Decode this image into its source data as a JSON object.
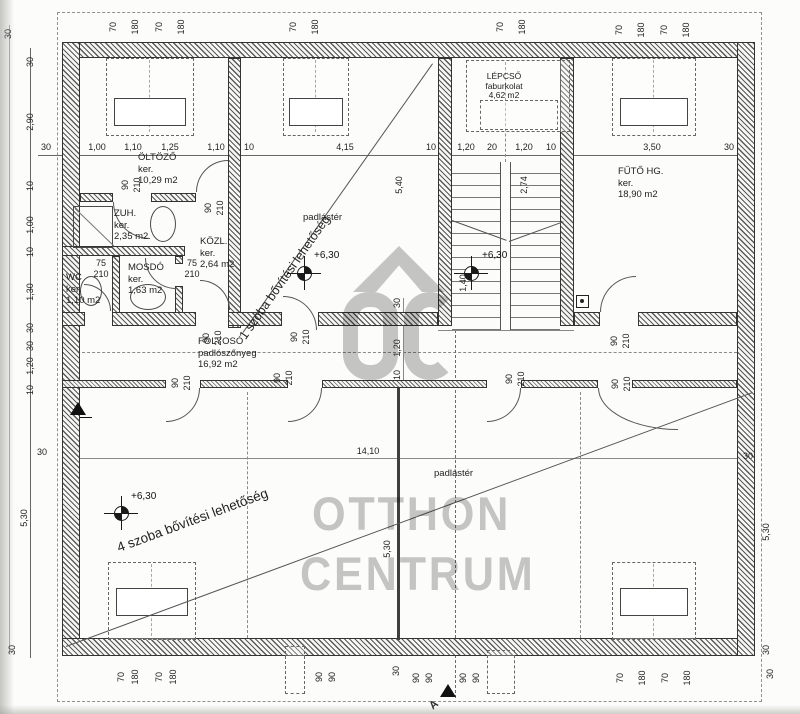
{
  "watermark": {
    "oc": "OC",
    "otthon": "OTTHON",
    "centrum": "CENTRUM"
  },
  "rooms": {
    "oltozo": {
      "name": "ÖLTÖZŐ",
      "floor": "ker.",
      "area": "10,29 m2"
    },
    "zuh": {
      "name": "ZUH.",
      "floor": "ker.",
      "area": "2,35 m2"
    },
    "kozl": {
      "name": "KÖZL.",
      "floor": "ker.",
      "area": "2,64 m2"
    },
    "wc": {
      "name": "WC",
      "floor": "ker.",
      "area": "1,10 m2"
    },
    "mosdo": {
      "name": "MOSDÓ",
      "floor": "ker.",
      "area": "1,63 m2"
    },
    "lepcso": {
      "name": "LÉPCSŐ",
      "floor": "faburkolat",
      "area": "4,62 m2"
    },
    "futo": {
      "name": "FŰTŐ HG.",
      "floor": "ker.",
      "area": "18,90 m2"
    },
    "folyoso": {
      "name": "FOLYOSÓ",
      "floor": "padlószőnyeg",
      "area": "16,92 m2"
    },
    "attic_top": {
      "label": "padlástér"
    },
    "attic_bottom": {
      "label": "padlástér"
    }
  },
  "annotations": {
    "expand1": "1 szoba bővítési lehetőség",
    "expand4": "4 szoba bővítési lehetőség",
    "level_top": "+6,30",
    "level_right": "+6,30",
    "level_bottom": "+6,30",
    "section_a": "A"
  },
  "dim_labels": [
    [
      "70",
      113,
      27,
      1
    ],
    [
      "180",
      135,
      27,
      1
    ],
    [
      "70",
      159,
      27,
      1
    ],
    [
      "180",
      181,
      27,
      1
    ],
    [
      "70",
      293,
      27,
      1
    ],
    [
      "180",
      315,
      27,
      1
    ],
    [
      "70",
      500,
      27,
      1
    ],
    [
      "180",
      522,
      27,
      1
    ],
    [
      "70",
      619,
      30,
      1
    ],
    [
      "180",
      641,
      30,
      1
    ],
    [
      "70",
      664,
      30,
      1
    ],
    [
      "180",
      686,
      30,
      1
    ],
    [
      "30",
      46,
      147,
      0
    ],
    [
      "1,00",
      97,
      147,
      0
    ],
    [
      "1,10",
      133,
      147,
      0
    ],
    [
      "1,25",
      170,
      147,
      0
    ],
    [
      "1,10",
      216,
      147,
      0
    ],
    [
      "10",
      249,
      147,
      0
    ],
    [
      "4,15",
      345,
      147,
      0
    ],
    [
      "10",
      431,
      147,
      0
    ],
    [
      "1,20",
      466,
      147,
      0
    ],
    [
      "20",
      492,
      147,
      0
    ],
    [
      "1,20",
      524,
      147,
      0
    ],
    [
      "10",
      551,
      147,
      0
    ],
    [
      "3,50",
      652,
      147,
      0
    ],
    [
      "30",
      729,
      147,
      0
    ],
    [
      "30",
      8,
      34,
      1
    ],
    [
      "30",
      30,
      62,
      1
    ],
    [
      "2,90",
      30,
      122,
      1
    ],
    [
      "10",
      30,
      186,
      1
    ],
    [
      "1,00",
      30,
      225,
      1
    ],
    [
      "10",
      30,
      252,
      1
    ],
    [
      "1,30",
      30,
      292,
      1
    ],
    [
      "30",
      30,
      328,
      1
    ],
    [
      "30",
      30,
      346,
      1
    ],
    [
      "1,20",
      30,
      366,
      1
    ],
    [
      "10",
      30,
      390,
      1
    ],
    [
      "30",
      42,
      452,
      0
    ],
    [
      "5,30",
      24,
      518,
      1
    ],
    [
      "30",
      12,
      650,
      1
    ],
    [
      "30",
      748,
      456,
      0
    ],
    [
      "5,30",
      766,
      532,
      1
    ],
    [
      "30",
      766,
      650,
      1
    ],
    [
      "70",
      121,
      677,
      1
    ],
    [
      "180",
      135,
      677,
      1
    ],
    [
      "70",
      159,
      677,
      1
    ],
    [
      "180",
      173,
      677,
      1
    ],
    [
      "90",
      319,
      677,
      1
    ],
    [
      "90",
      332,
      677,
      1
    ],
    [
      "30",
      396,
      671,
      1
    ],
    [
      "90",
      416,
      678,
      1
    ],
    [
      "90",
      429,
      678,
      1
    ],
    [
      "90",
      463,
      678,
      1
    ],
    [
      "90",
      476,
      678,
      1
    ],
    [
      "70",
      620,
      678,
      1
    ],
    [
      "180",
      642,
      678,
      1
    ],
    [
      "70",
      665,
      678,
      1
    ],
    [
      "180",
      687,
      678,
      1
    ],
    [
      "30",
      770,
      674,
      1
    ],
    [
      "5,40",
      399,
      185,
      1
    ],
    [
      "2,74",
      524,
      185,
      1
    ],
    [
      "1,40",
      463,
      283,
      1
    ],
    [
      "30",
      397,
      303,
      1
    ],
    [
      "1,20",
      397,
      348,
      1
    ],
    [
      "10",
      397,
      375,
      1
    ],
    [
      "14,10",
      368,
      451,
      0
    ],
    [
      "5,30",
      387,
      549,
      1
    ],
    [
      "90",
      125,
      185,
      1
    ],
    [
      "210",
      137,
      185,
      1
    ],
    [
      "90",
      208,
      208,
      1
    ],
    [
      "210",
      220,
      208,
      1
    ],
    [
      "75",
      101,
      263,
      0
    ],
    [
      "210",
      101,
      274,
      0
    ],
    [
      "75",
      192,
      263,
      0
    ],
    [
      "210",
      192,
      274,
      0
    ],
    [
      "90",
      206,
      338,
      1
    ],
    [
      "210",
      218,
      338,
      1
    ],
    [
      "90",
      294,
      337,
      1
    ],
    [
      "210",
      306,
      337,
      1
    ],
    [
      "90",
      614,
      341,
      1
    ],
    [
      "210",
      626,
      341,
      1
    ],
    [
      "90",
      175,
      383,
      1
    ],
    [
      "210",
      187,
      383,
      1
    ],
    [
      "90",
      277,
      378,
      1
    ],
    [
      "210",
      289,
      378,
      1
    ],
    [
      "90",
      509,
      379,
      1
    ],
    [
      "210",
      521,
      379,
      1
    ],
    [
      "90",
      615,
      384,
      1
    ],
    [
      "210",
      627,
      384,
      1
    ]
  ]
}
